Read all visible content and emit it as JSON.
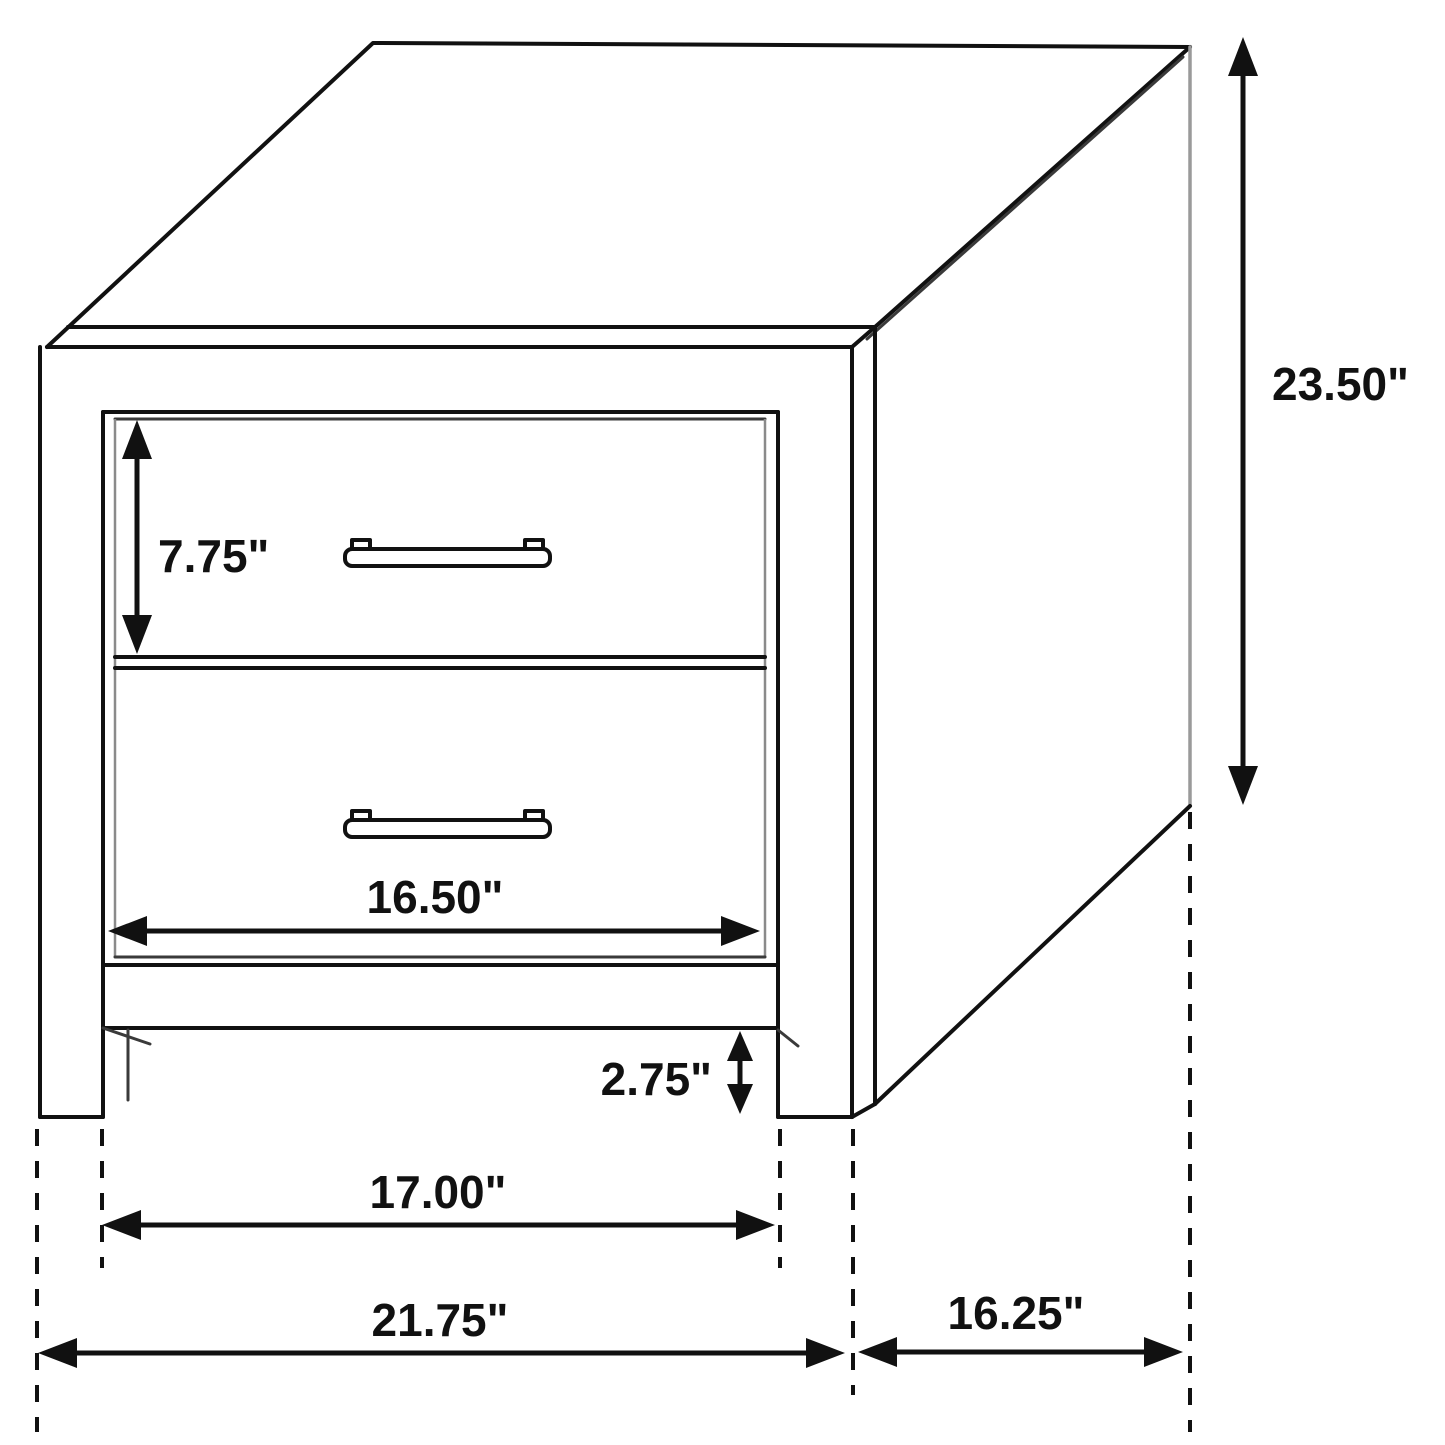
{
  "diagram": {
    "subject": "two-drawer-nightstand-dimension-drawing",
    "units": "inches",
    "colors": {
      "background": "#ffffff",
      "line": "#111111",
      "gray_edge": "#9a9a9a",
      "text": "#111111"
    },
    "labels": {
      "drawer_height": "7.75\"",
      "overall_height": "23.50\"",
      "drawer_width": "16.50\"",
      "foot_height": "2.75\"",
      "inner_width": "17.00\"",
      "overall_width": "21.75\"",
      "overall_depth": "16.25\""
    }
  }
}
